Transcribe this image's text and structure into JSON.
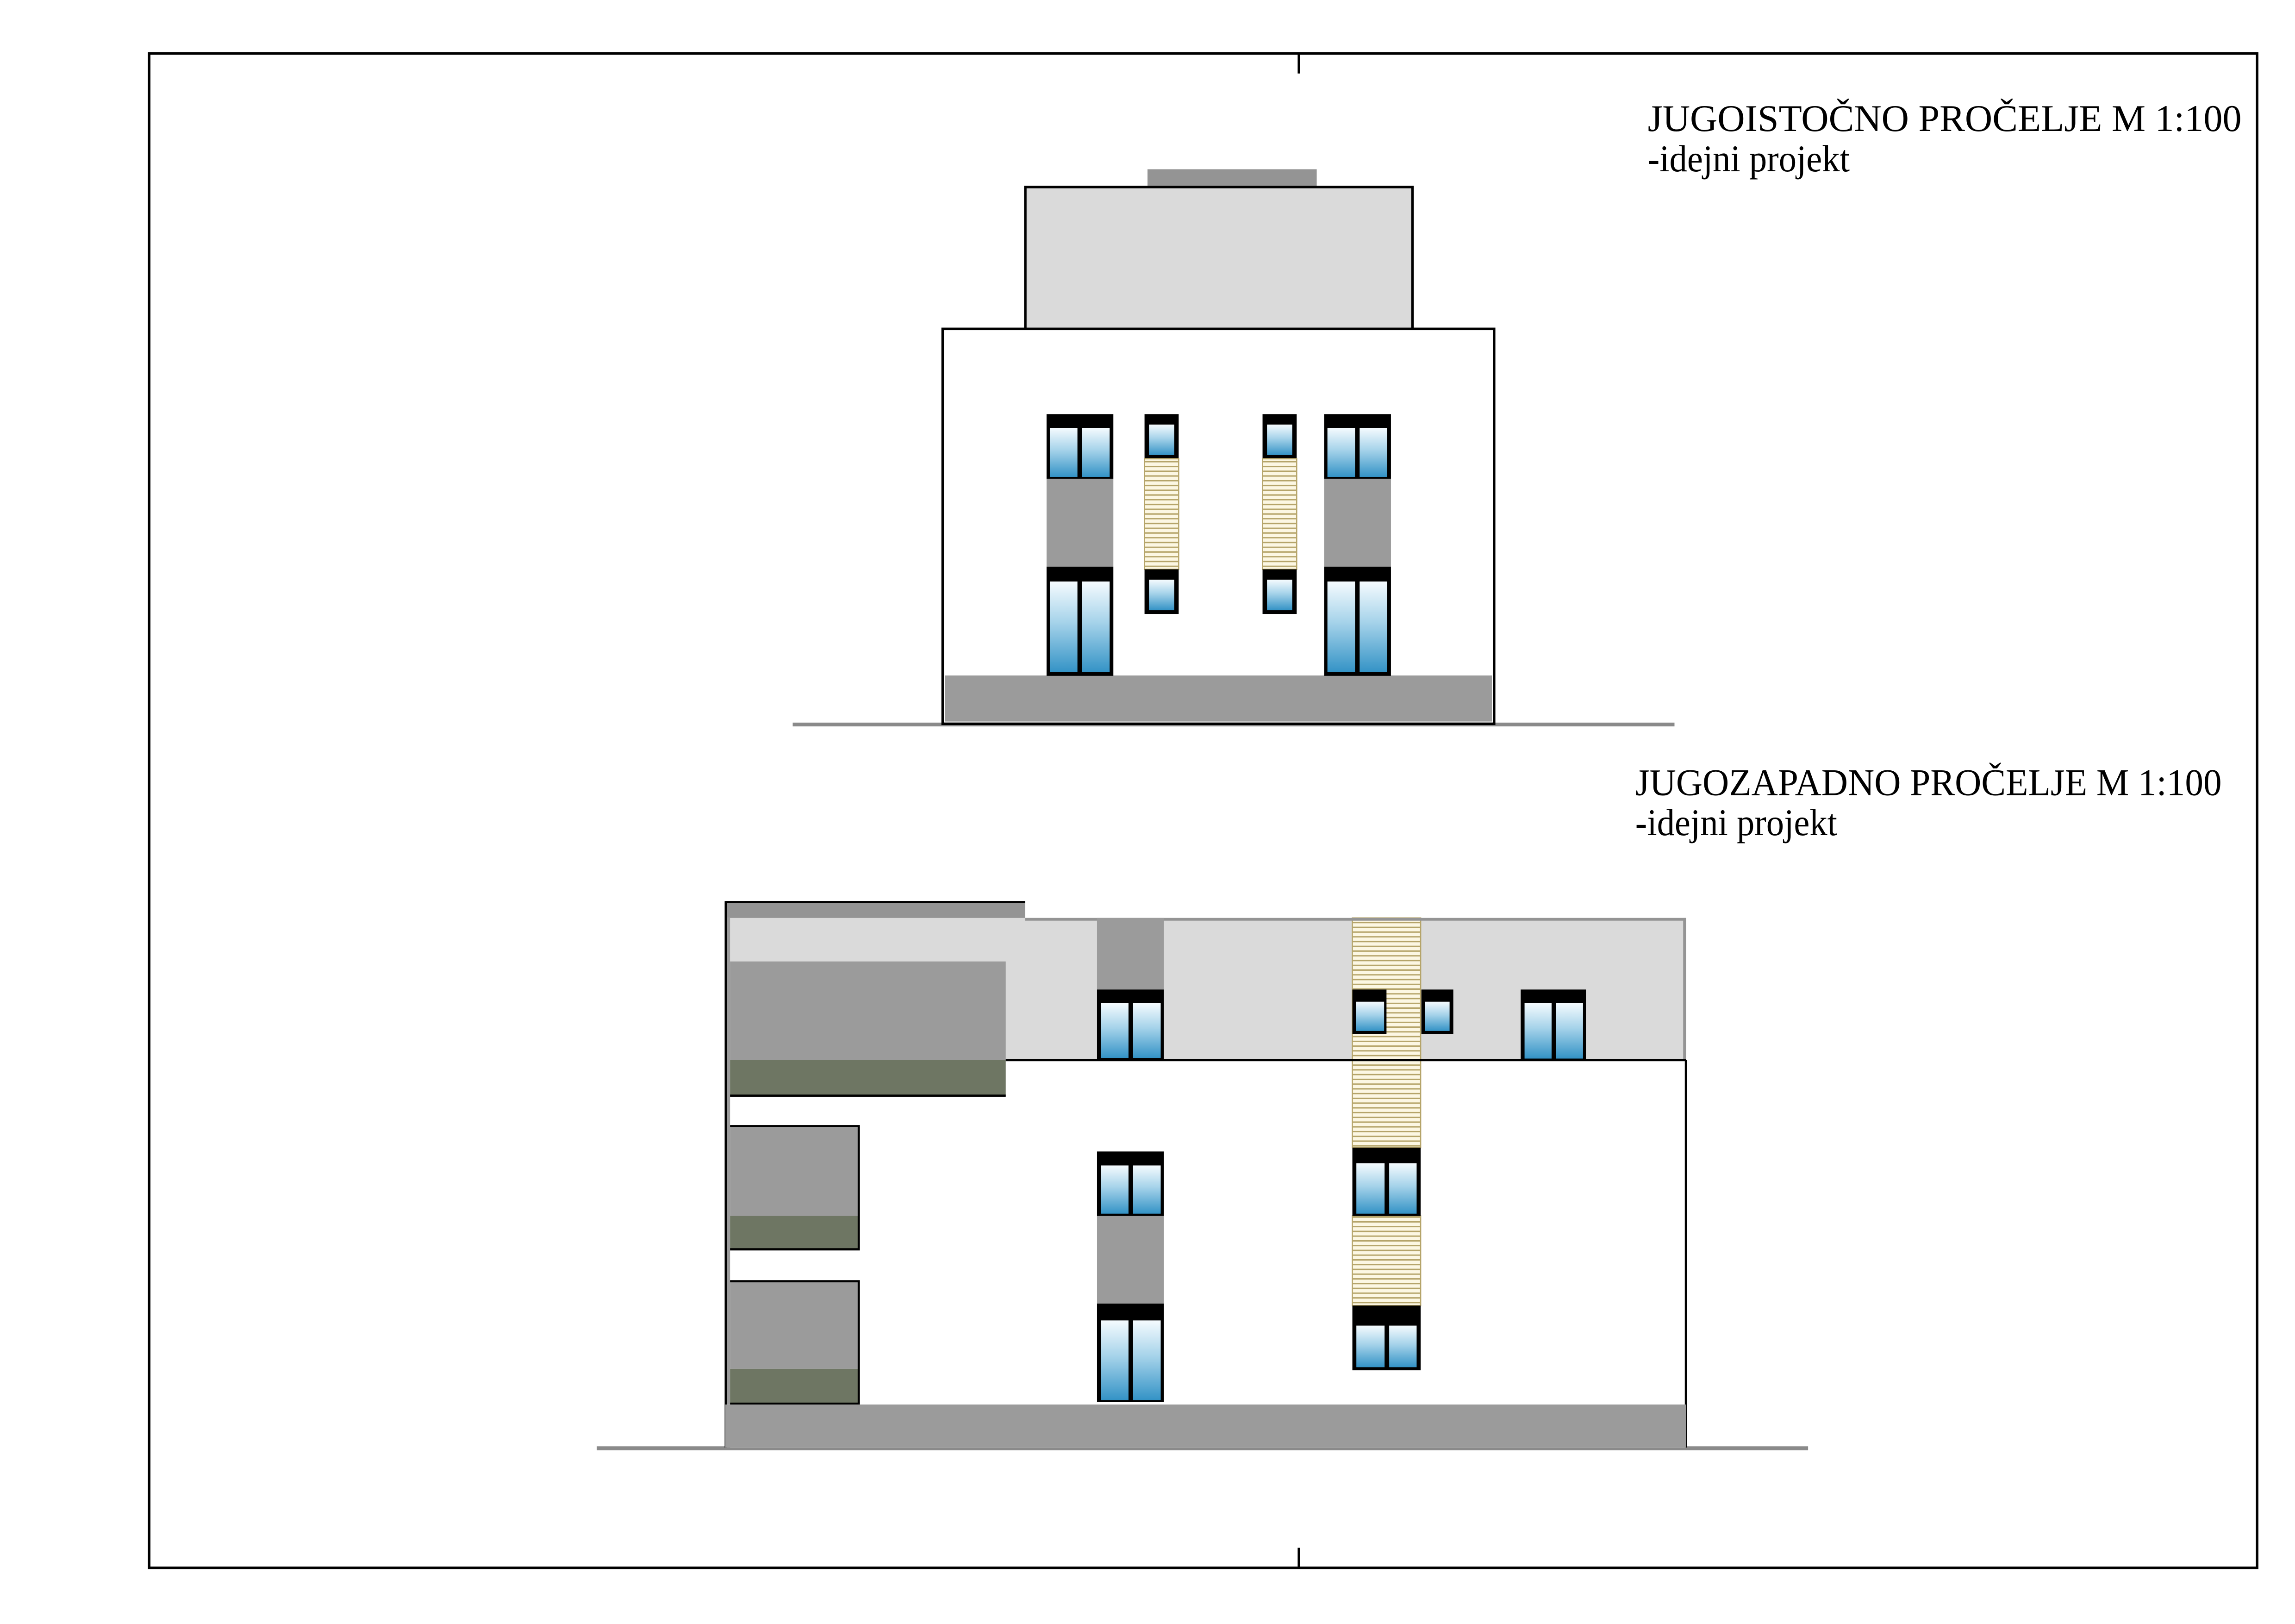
{
  "sheet": {
    "background": "#ffffff",
    "border_color": "#000000"
  },
  "elevations": {
    "southeast": {
      "title": "JUGOISTOČNO PROČELJE M 1:100",
      "subtitle": "-idejni projekt"
    },
    "southwest": {
      "title": "JUGOZAPADNO PROČELJE M 1:100",
      "subtitle": "-idejni projekt"
    }
  },
  "palette": {
    "outline": "#000000",
    "wall_white": "#ffffff",
    "light_gray": "#dadada",
    "mid_gray": "#9b9b9b",
    "roof_gray": "#949494",
    "olive_green": "#6e7663",
    "shutter_cream": "#fcf7e3",
    "shutter_line": "#b5a469",
    "glass_top": "#f5fbfe",
    "glass_mid": "#a6d3ea",
    "glass_bottom": "#3493c6",
    "ground_line": "#8a8a8a"
  }
}
